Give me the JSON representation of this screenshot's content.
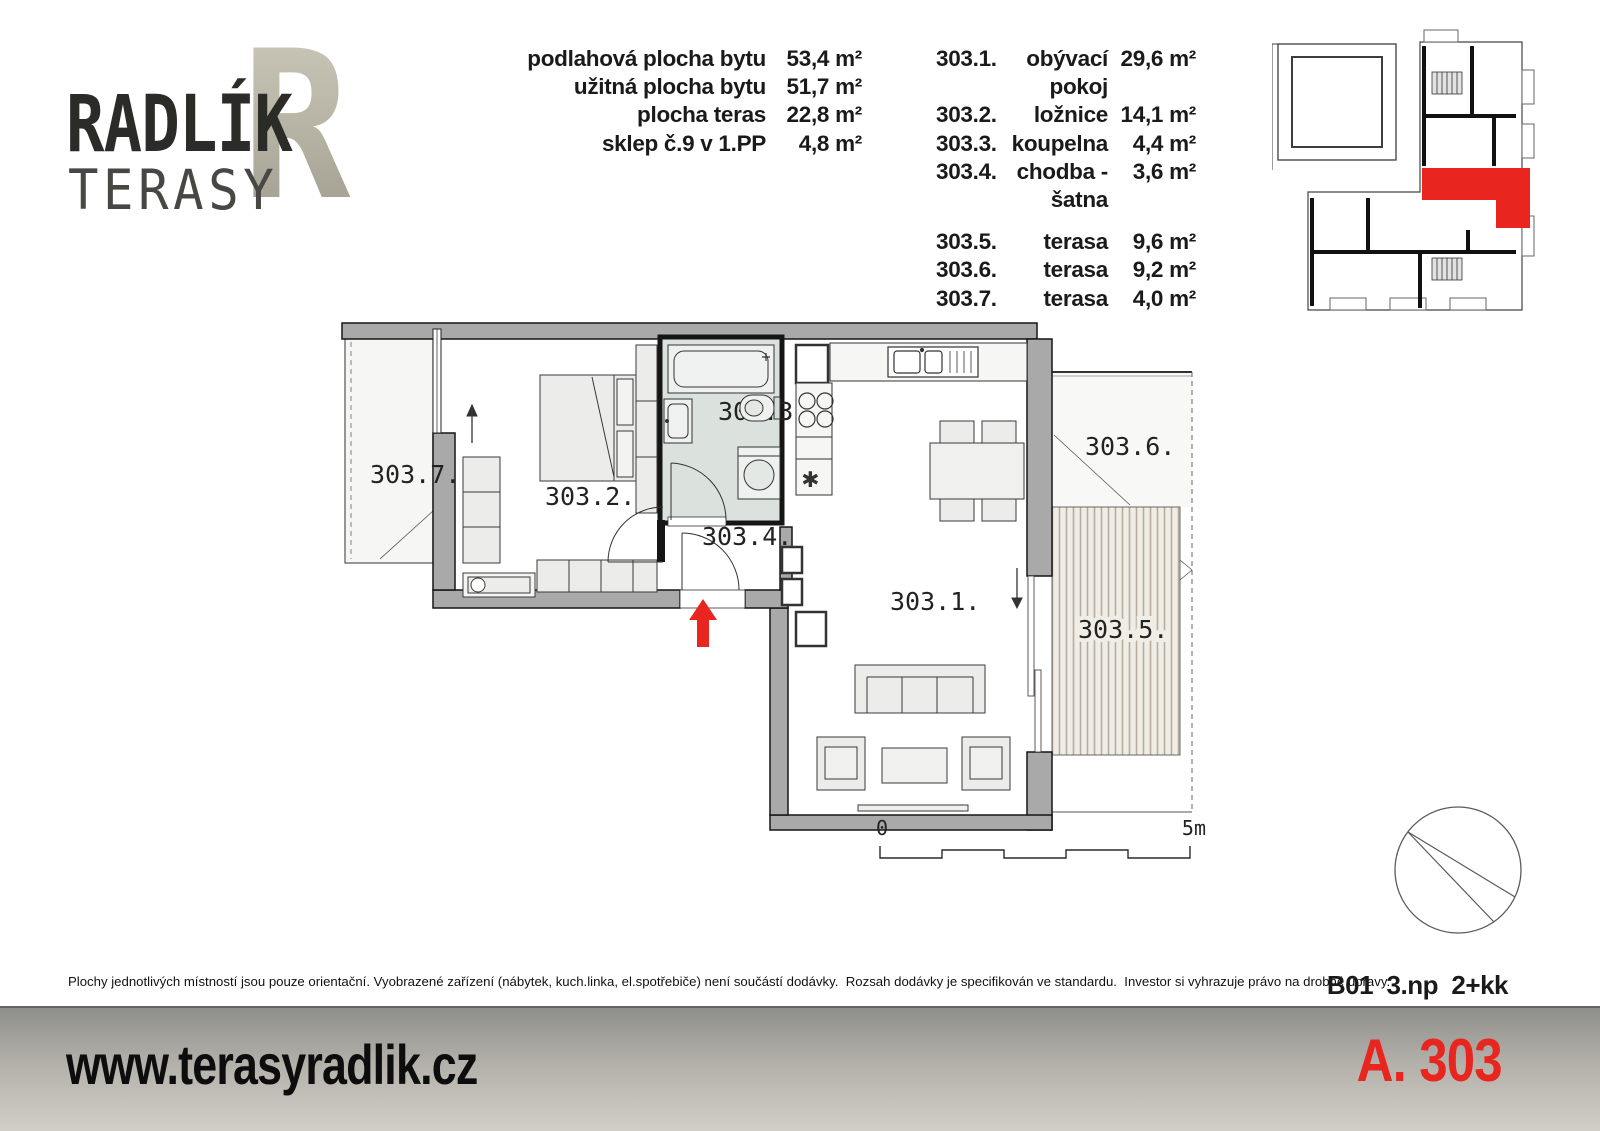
{
  "logo": {
    "title": "RADLÍK",
    "subtitle": "TERASY",
    "monogram": "R"
  },
  "summary": {
    "rows": [
      {
        "label": "podlahová plocha bytu",
        "value": "53,4 m²"
      },
      {
        "label": "užitná plocha bytu",
        "value": "51,7 m²"
      },
      {
        "label": "plocha teras",
        "value": "22,8 m²"
      },
      {
        "label": "sklep č.9 v 1.PP",
        "value": "4,8 m²"
      }
    ]
  },
  "rooms": [
    {
      "id": "303.1.",
      "name": "obývací pokoj",
      "area": "29,6 m²"
    },
    {
      "id": "303.2.",
      "name": "ložnice",
      "area": "14,1 m²"
    },
    {
      "id": "303.3.",
      "name": "koupelna",
      "area": "4,4 m²"
    },
    {
      "id": "303.4.",
      "name": "chodba - šatna",
      "area": "3,6 m²"
    },
    {
      "id": "303.5.",
      "name": "terasa",
      "area": "9,6 m²"
    },
    {
      "id": "303.6.",
      "name": "terasa",
      "area": "9,2 m²"
    },
    {
      "id": "303.7.",
      "name": "terasa",
      "area": "4,0 m²"
    }
  ],
  "floor_plan": {
    "labels": {
      "living": "303.1.",
      "bedroom": "303.2.",
      "bathroom": "303.3.",
      "hall": "303.4.",
      "terrace_large": "303.5.",
      "terrace_side": "303.6.",
      "terrace_small": "303.7."
    },
    "scale": {
      "start": "0",
      "end": "5m"
    }
  },
  "notes": {
    "disclaimer": "Plochy jednotlivých místností jsou pouze orientační. Vyobrazené zařízení (nábytek, kuch.linka, el.spotřebiče) není součástí dodávky.  Rozsah dodávky je specifikován ve standardu.  Investor si vyhrazuje právo na drobné úpravy.",
    "unit_spec": "B01  3.np  2+kk"
  },
  "footer": {
    "website": "www.terasyradlik.cz",
    "unit_code": "A. 303"
  },
  "colors": {
    "accent_red": "#e8251f",
    "wall_gray": "#a9a9a9",
    "bathroom_fill": "#dbe2de",
    "deck_stripe": "#b5ae9f"
  }
}
